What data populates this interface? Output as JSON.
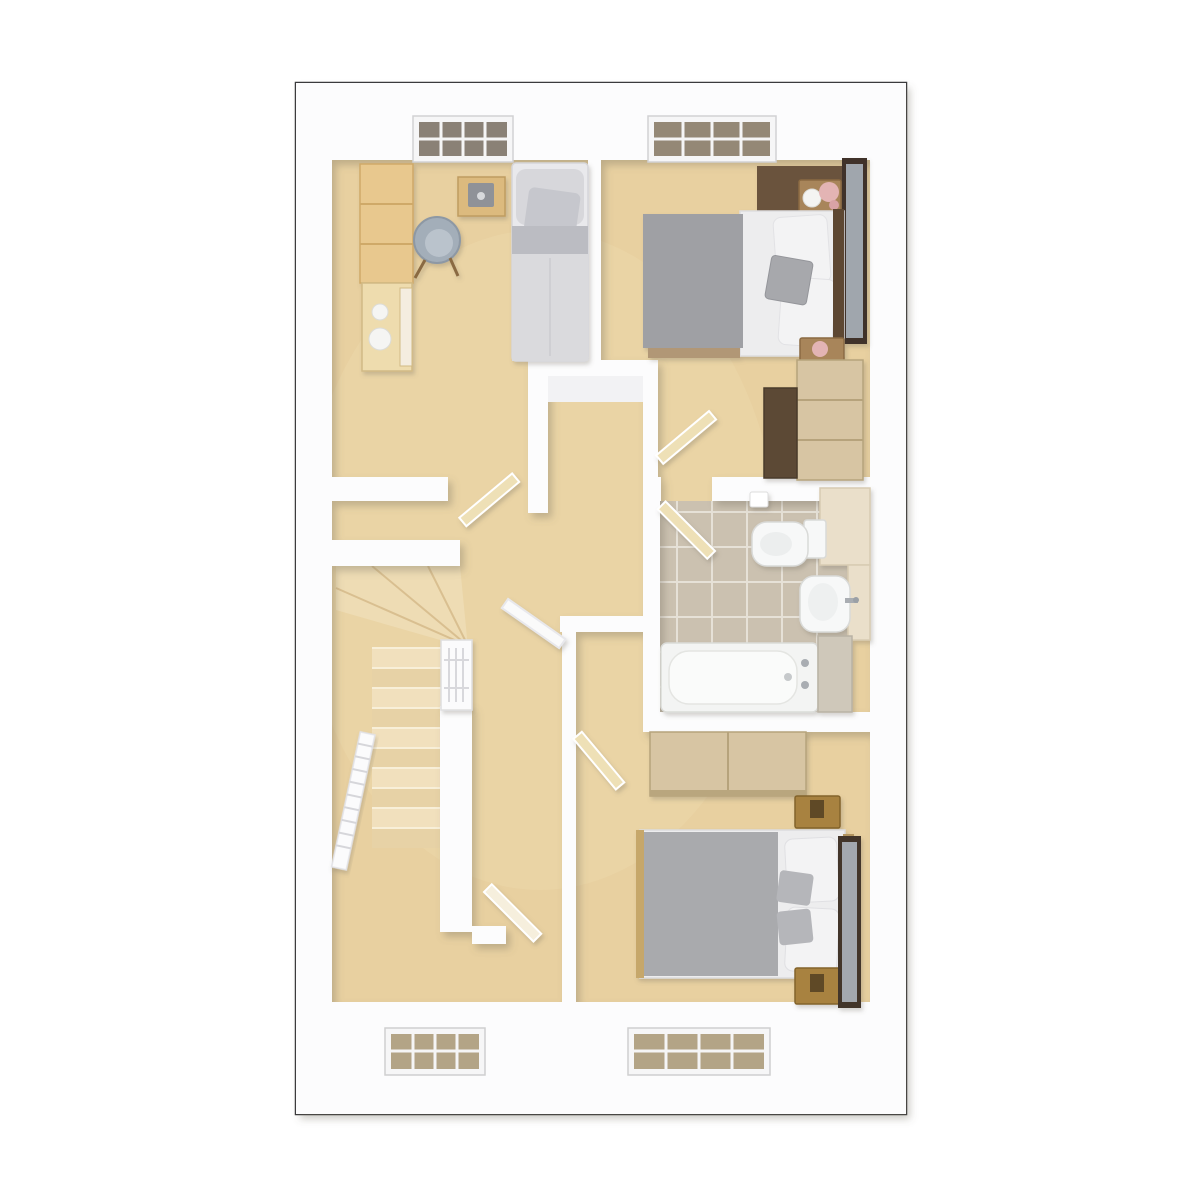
{
  "meta": {
    "kind": "3d-floor-plan-render",
    "view": "top-down dollhouse",
    "floor_label": "First floor",
    "visible_text": "none"
  },
  "palette": {
    "page_bg": "#ffffff",
    "plan_border": "#3a3a3c",
    "wall": "#fcfcfd",
    "wall_face": "#f2f2f4",
    "floor": "#e8d0a0",
    "floor_light": "#eedcb4",
    "tile": "#cbc1b0",
    "grout": "#e6e1d7",
    "wood": "#e8c88e",
    "wood_pale": "#d7c5a3",
    "wood_gold": "#a8823f",
    "wood_mid": "#a8855a",
    "wood_dark": "#5c4936",
    "headboard_dark": "#6a523c",
    "door": "#eee0b6",
    "door_white": "#fafafa",
    "linen": "#f3f3f4",
    "sheet": "#ededee",
    "duvet": "#9fa0a4",
    "duvet2": "#a9aaad",
    "cushion": "#a7a8ac",
    "fixture": "#f7f8f8",
    "glass_top": "#8a8176",
    "glass_bottom": "#b3a486",
    "frame_white": "#f6f6f7",
    "chair": "#a3aeb9",
    "counter": "#eadfca",
    "tread_a": "#f1e0bd",
    "tread_b": "#e7d2a6"
  },
  "rooms": [
    {
      "id": "bedroom-single",
      "position": "top-left",
      "flooring": "beige carpet",
      "furniture": [
        "single bed with grey bedding",
        "desk with seat",
        "grey tub chair",
        "tall pine wardrobe",
        "chest of drawers with two white lamps"
      ],
      "window": "top wall, 8-pane white frame"
    },
    {
      "id": "bedroom-double-1",
      "position": "top-right",
      "flooring": "beige carpet",
      "furniture": [
        "double bed grey duvet white linen",
        "dark headboard feature panel",
        "bedside table with lamp and pink flowers",
        "second bedside table with pink flowers",
        "tall leaning mirror",
        "light-wood dresser",
        "dark-wood wardrobe"
      ],
      "window": "top wall, 12-pane white frame"
    },
    {
      "id": "bathroom",
      "position": "middle-right",
      "flooring": "taupe ceramic tiles",
      "furniture": [
        "toilet with cistern and wall roll holder",
        "pedestal basin with chrome tap",
        "bathtub with chrome taps",
        "vanity counter",
        "side cabinet"
      ],
      "window": "none"
    },
    {
      "id": "bedroom-double-2",
      "position": "bottom-right",
      "flooring": "beige carpet",
      "furniture": [
        "double bed grey duvet white linen",
        "two gold-wood bedside tables",
        "tall leaning mirror",
        "light-wood wardrobe"
      ],
      "window": "bottom wall, 12-pane white frame"
    },
    {
      "id": "landing",
      "position": "center",
      "flooring": "beige carpet",
      "furniture": [
        "airing-cupboard recess"
      ],
      "window": "none"
    },
    {
      "id": "stairwell",
      "position": "center-left",
      "flooring": "carpeted treads",
      "furniture": [
        "quarter-turn winder stairs",
        "white newel post with lattice balustrade",
        "white spindle banister"
      ],
      "window": "none"
    },
    {
      "id": "store-room",
      "position": "bottom-left",
      "flooring": "beige carpet",
      "furniture": [],
      "window": "bottom wall, 12-pane white frame"
    }
  ],
  "doors": [
    {
      "id": "door-bedroom-single",
      "state": "open",
      "leaf": "light wood"
    },
    {
      "id": "door-bedroom-double-1",
      "state": "open",
      "leaf": "light wood"
    },
    {
      "id": "door-bathroom",
      "state": "open",
      "leaf": "light wood"
    },
    {
      "id": "door-landing-nook",
      "state": "open",
      "leaf": "white"
    },
    {
      "id": "door-bedroom-double-2",
      "state": "open",
      "leaf": "light wood"
    },
    {
      "id": "door-store-room",
      "state": "open",
      "leaf": "pale wood"
    }
  ],
  "windows": [
    {
      "id": "window-top-left",
      "wall": "north",
      "glass": "dark reflective"
    },
    {
      "id": "window-top-right",
      "wall": "north",
      "glass": "dark reflective"
    },
    {
      "id": "window-bottom-left",
      "wall": "south",
      "glass": "tan reflective"
    },
    {
      "id": "window-bottom-right",
      "wall": "south",
      "glass": "tan reflective"
    }
  ]
}
